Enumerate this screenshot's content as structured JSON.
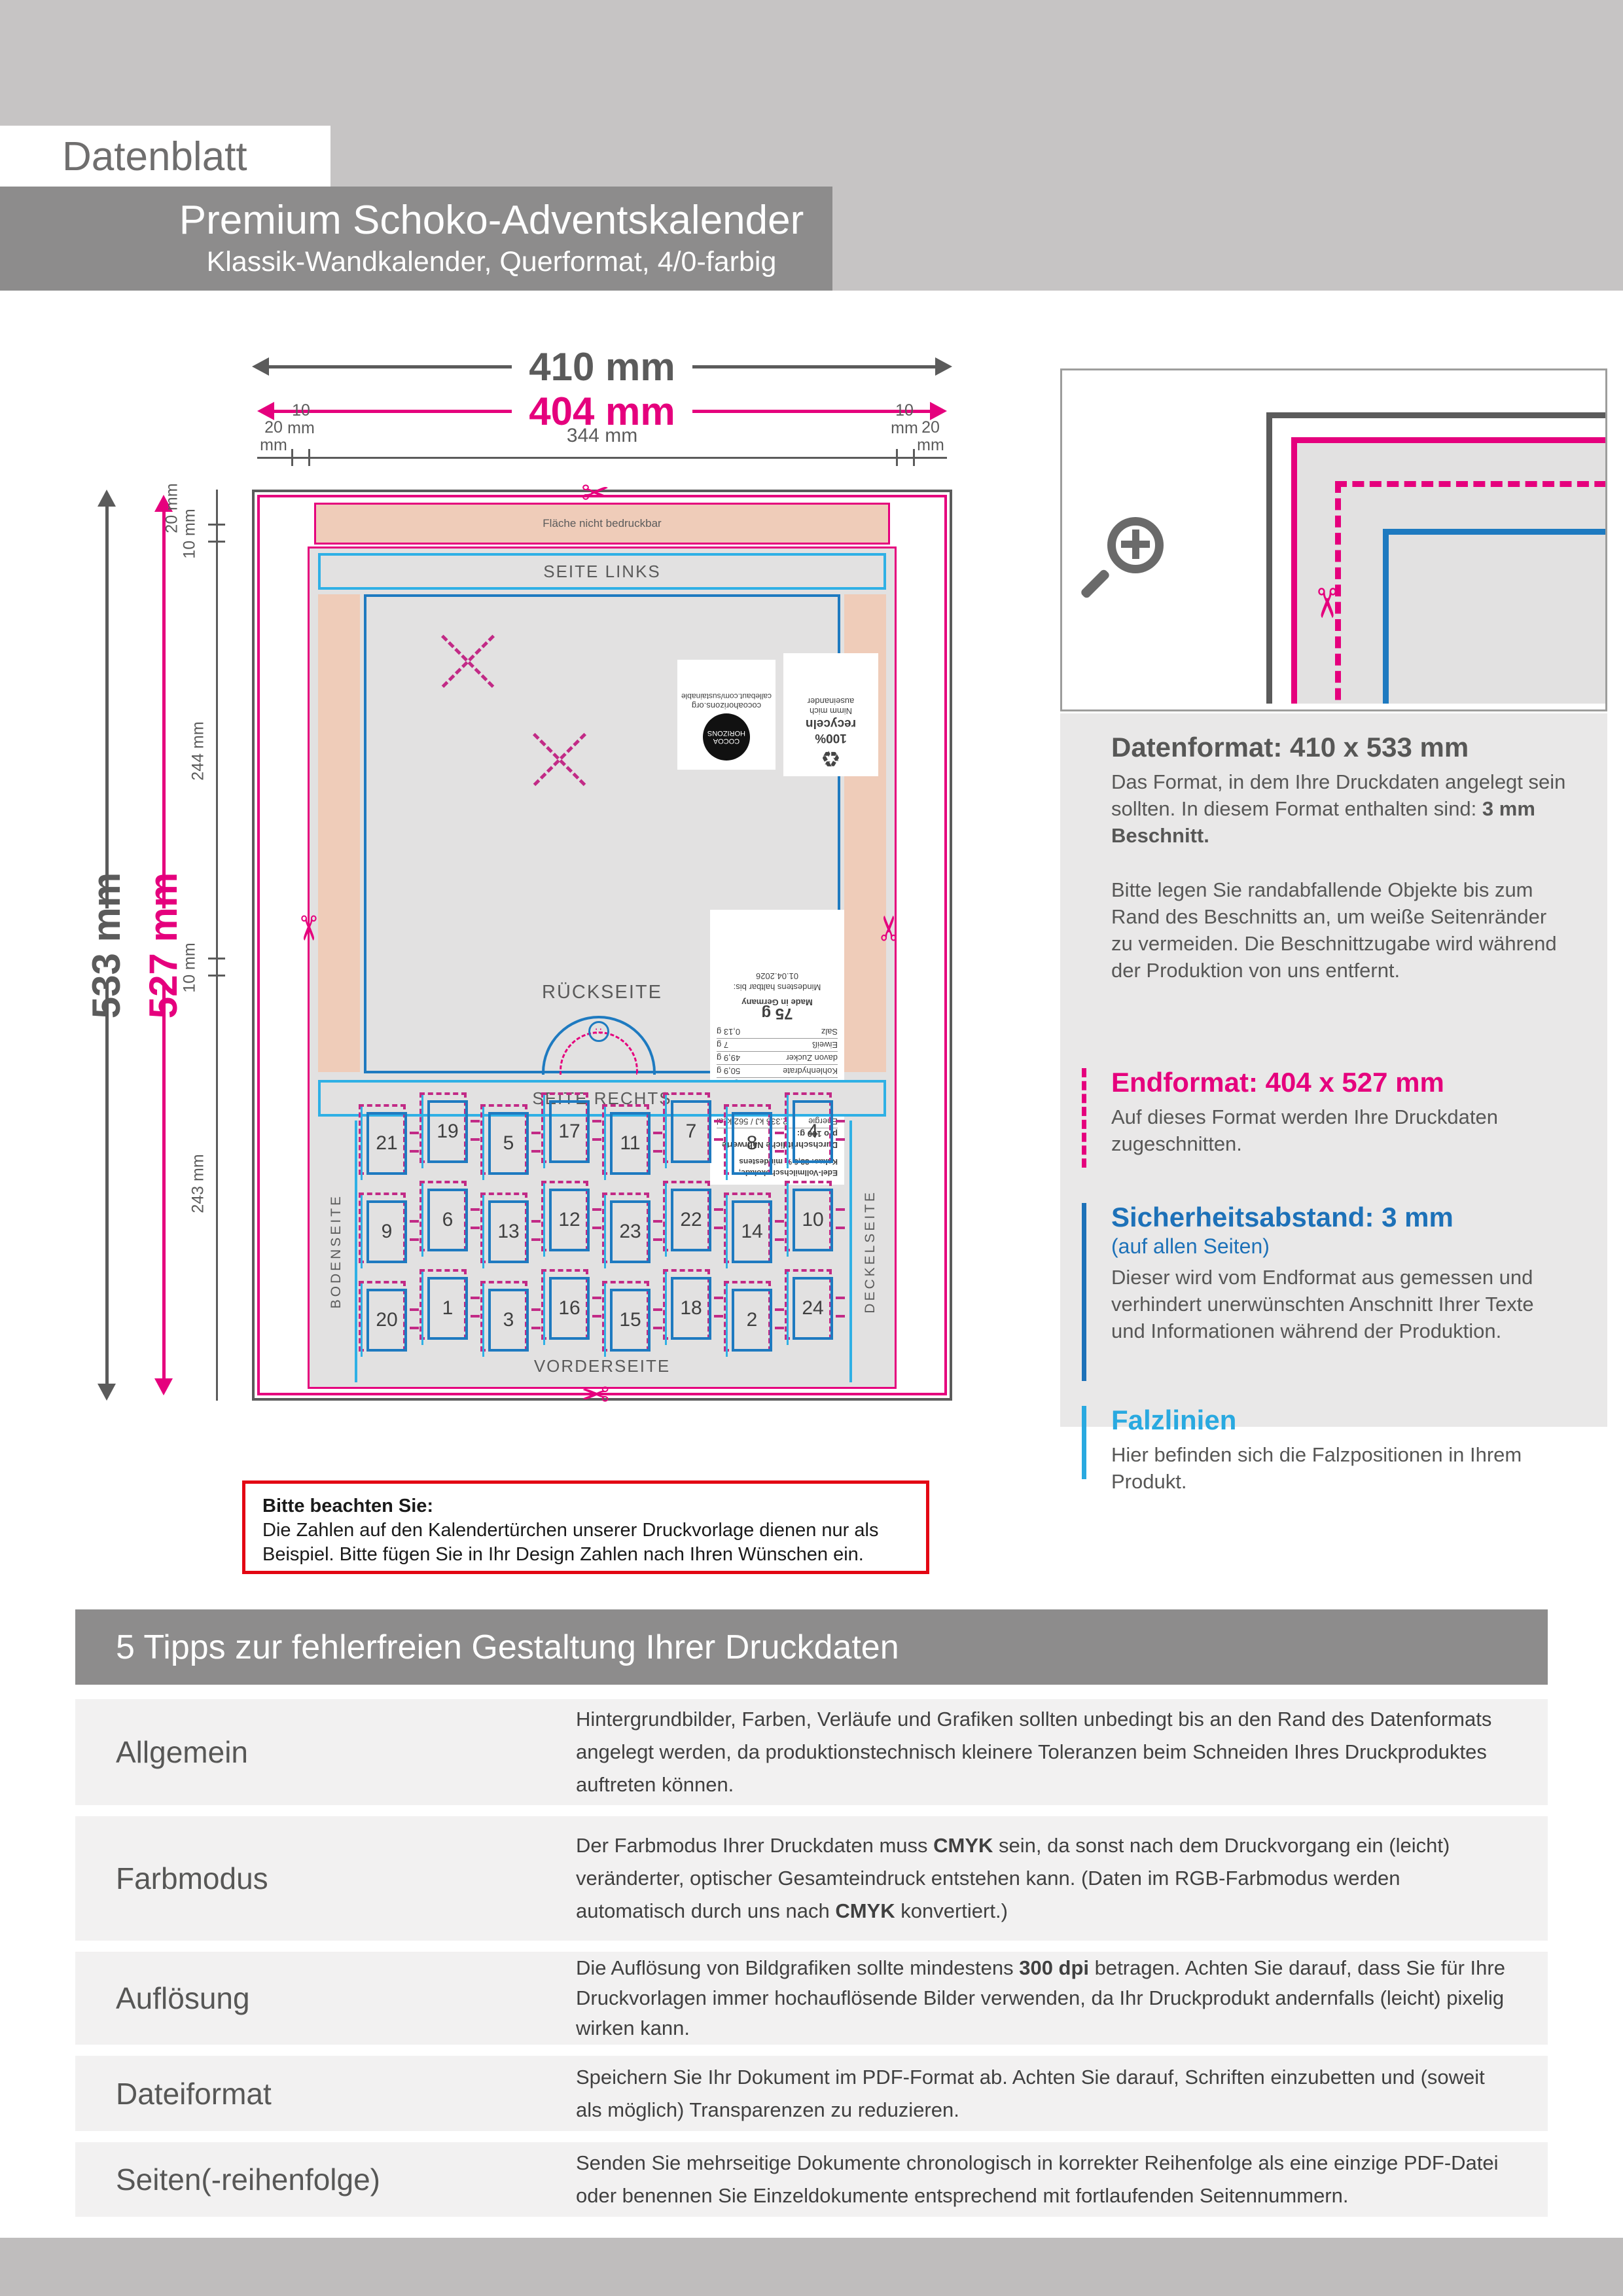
{
  "header": {
    "datenblatt": "Datenblatt",
    "title": "Premium Schoko-Adventskalender",
    "subtitle": "Klassik-Wandkalender, Querformat, 4/0-farbig"
  },
  "diagram": {
    "width_outer": "410 mm",
    "width_end": "404 mm",
    "height_outer": "533 mm",
    "height_end": "527 mm",
    "ruler_top": [
      "20\nmm",
      "10\nmm",
      "344 mm",
      "10\nmm",
      "20\nmm"
    ],
    "ruler_left": [
      "20 mm",
      "10 mm",
      "244 mm",
      "10 mm",
      "243 mm"
    ],
    "panels": {
      "flap": "Fläche nicht bedruckbar",
      "seite_links": "SEITE LINKS",
      "rueckseite": "RÜCKSEITE",
      "seite_rechts": "SEITE RECHTS",
      "vorderseite": "VORDERSEITE",
      "bodenseite": "BODENSEITE",
      "deckelseite": "DECKELSEITE"
    },
    "doors": [
      [
        21,
        19,
        5,
        17,
        11,
        7,
        8,
        4
      ],
      [
        9,
        6,
        13,
        12,
        23,
        22,
        14,
        10
      ],
      [
        20,
        1,
        3,
        16,
        15,
        18,
        2,
        24
      ]
    ],
    "back_labels": {
      "recycle_title": "100% recyceln",
      "recycle_sub": "Nimm mich auseinander",
      "recycle_icon": "♻",
      "cocoa_circle": "COCOA HORIZONS",
      "cocoa_l1": "cocoahorizons.org",
      "cocoa_l2": "callebaut.com/sustainable",
      "dots": "∷"
    },
    "nutrition": {
      "ingredients": "Edel-Vollmilchschokolade, Kakao: 33,6 % mindestens",
      "title": "Durchschnittliche Nährwerte pro 100 g:",
      "rows": [
        [
          "Energie",
          "2.336 kJ / 562 kcal"
        ],
        [
          "Fett",
          "36,2 g"
        ],
        [
          "davon gesättigte Fettsäuren",
          "21,6 g"
        ],
        [
          "Kohlenhydrate",
          "50,9 g"
        ],
        [
          "davon Zucker",
          "49,9 g"
        ],
        [
          "Eiweiß",
          "7 g"
        ],
        [
          "Salz",
          "0,13 g"
        ]
      ],
      "weight": "75 g",
      "origin": "Made in Germany",
      "mhd": "Mindestens haltbar bis:",
      "mhd_date": "01.04.2026"
    }
  },
  "info": {
    "datenformat": {
      "heading": "Datenformat: 410 x 533 mm",
      "p1": [
        {
          "t": "Das Format, in dem Ihre Druckdaten angelegt sein sollten. In diesem Format enthalten sind: "
        },
        {
          "t": "3 mm Beschnitt.",
          "b": true
        }
      ],
      "p2": "Bitte legen Sie randabfallende Objekte bis zum Rand des Beschnitts an, um weiße Seitenränder zu vermeiden. Die Beschnittzugabe wird während der Produktion von uns entfernt."
    },
    "endformat": {
      "heading": "Endformat: 404 x 527 mm",
      "p": "Auf dieses Format werden Ihre Druckdaten zugeschnitten."
    },
    "sicherheit": {
      "heading": "Sicherheitsabstand: 3 mm",
      "sub": "(auf allen Seiten)",
      "p": "Dieser wird vom Endformat aus gemessen und verhindert unerwünschten Anschnitt Ihrer Texte und Informationen während der Produktion."
    },
    "falz": {
      "heading": "Falzlinien",
      "p": "Hier befinden sich die Falzpositionen in Ihrem Produkt."
    }
  },
  "note": {
    "heading": "Bitte beachten Sie:",
    "text": "Die Zahlen auf den Kalendertürchen unserer Druckvorlage dienen nur als Beispiel. Bitte fügen Sie in Ihr Design Zahlen nach Ihren Wünschen ein."
  },
  "tips": {
    "title": "5 Tipps zur fehlerfreien Gestaltung Ihrer Druckdaten",
    "rows": [
      {
        "label": "Allgemein",
        "parts": [
          {
            "t": "Hintergrundbilder, Farben, Verläufe und Grafiken sollten unbedingt bis an den Rand des Datenformats angelegt werden, da produktionstechnisch kleinere Toleranzen beim Schneiden Ihres Druckproduktes auftreten können."
          }
        ]
      },
      {
        "label": "Farbmodus",
        "parts": [
          {
            "t": "Der Farbmodus Ihrer Druckdaten muss "
          },
          {
            "t": "CMYK",
            "b": true
          },
          {
            "t": " sein, da sonst nach dem Druckvorgang ein (leicht) veränderter, optischer Gesamteindruck entstehen kann. (Daten im RGB-Farbmodus werden automatisch durch uns nach "
          },
          {
            "t": "CMYK",
            "b": true
          },
          {
            "t": " konvertiert.)"
          }
        ]
      },
      {
        "label": "Auflösung",
        "parts": [
          {
            "t": "Die Auflösung von Bildgrafiken sollte mindestens "
          },
          {
            "t": "300 dpi",
            "b": true
          },
          {
            "t": " betragen. Achten Sie darauf, dass Sie für Ihre Druckvorlagen immer hochauflösende Bilder verwenden, da Ihr Druckprodukt andernfalls (leicht) pixelig wirken kann."
          }
        ]
      },
      {
        "label": "Dateiformat",
        "parts": [
          {
            "t": "Speichern Sie Ihr Dokument im PDF-Format ab. Achten Sie darauf, Schriften einzubetten und (soweit als möglich) Transparenzen zu reduzieren."
          }
        ]
      },
      {
        "label": "Seiten(-reihenfolge)",
        "parts": [
          {
            "t": "Senden Sie mehrseitige Dokumente chronologisch in korrekter Reihenfolge als eine einzige PDF-Datei oder benennen Sie Einzeldokumente entsprechend mit fortlaufenden Seitennummern."
          }
        ]
      }
    ]
  },
  "colors": {
    "magenta": "#e5007d",
    "cyan": "#2fb0e5",
    "blue": "#1e7ac0",
    "info_blue": "#1d71b8",
    "falz_cyan": "#29a9e0",
    "red": "#e30613",
    "peach": "#efccb9",
    "header_gray": "#8d8c8c",
    "band_gray": "#c6c4c4"
  },
  "icons": {
    "scissors": "✂",
    "magnifier_plus": "+"
  }
}
